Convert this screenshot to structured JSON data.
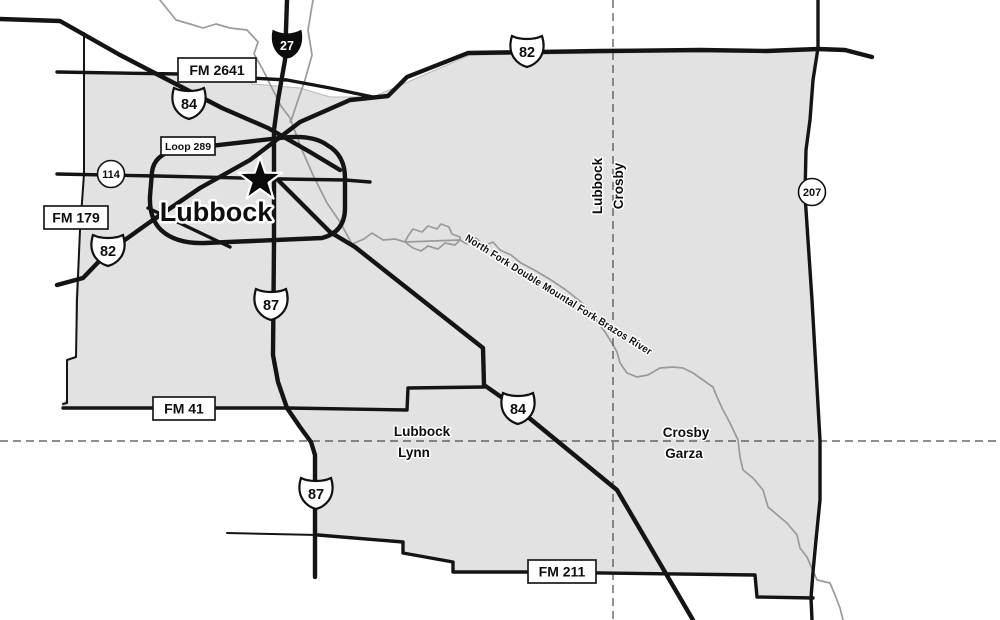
{
  "map": {
    "type": "county-highway-map",
    "colors": {
      "background": "#ffffff",
      "region_fill": "#e2e2e2",
      "road": "#141414",
      "river": "#9a9a9a",
      "dashed_boundary": "#4a4a4a"
    },
    "city": {
      "name": "Lubbock",
      "marker": "star"
    },
    "river": {
      "name": "North Fork Double Mountal Fork Brazos River"
    },
    "counties": {
      "northeast_pair": {
        "left": "Lubbock",
        "right": "Crosby"
      },
      "southwest_pair": {
        "top": "Lubbock",
        "bottom": "Lynn"
      },
      "southeast_pair": {
        "top": "Crosby",
        "bottom": "Garza"
      }
    },
    "shields": {
      "interstate_27": "27",
      "us_84_northwest": "84",
      "us_82_north": "82",
      "us_82_southwest": "82",
      "us_87_central": "87",
      "us_87_south": "87",
      "us_84_southeast": "84",
      "state_114": "114",
      "state_207": "207"
    },
    "road_boxes": {
      "fm_2641": "FM 2641",
      "loop_289": "Loop 289",
      "fm_179": "FM 179",
      "fm_41": "FM 41",
      "fm_211": "FM 211"
    }
  }
}
